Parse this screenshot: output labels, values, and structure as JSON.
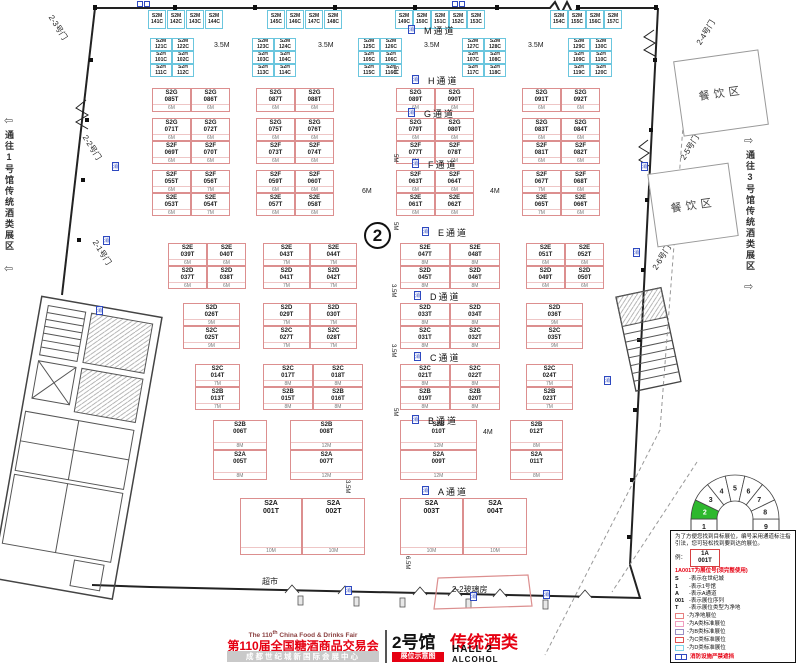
{
  "hall_circle": "2",
  "marker_glyph": "消",
  "corridor_left": {
    "text": "通往1号馆传统酒类展区",
    "arrow": "⇦"
  },
  "corridor_right": {
    "text": "通往3号馆传统酒类展区",
    "arrow": "⇨"
  },
  "doors": [
    {
      "label": "2-3号门",
      "x": 44,
      "y": 22,
      "side": "left"
    },
    {
      "label": "2-2号门",
      "x": 78,
      "y": 142,
      "side": "left"
    },
    {
      "label": "2-1号门",
      "x": 88,
      "y": 247,
      "side": "left"
    },
    {
      "label": "2-4号门",
      "x": 692,
      "y": 27,
      "side": "right"
    },
    {
      "label": "2-5号门",
      "x": 676,
      "y": 142,
      "side": "right"
    },
    {
      "label": "2-6号门",
      "x": 648,
      "y": 252,
      "side": "right"
    }
  ],
  "dining": [
    {
      "label": "餐饮区",
      "x": 678,
      "y": 55,
      "w": 86,
      "h": 76
    },
    {
      "label": "餐饮区",
      "x": 652,
      "y": 168,
      "w": 82,
      "h": 74
    }
  ],
  "aisles": [
    {
      "label": "M通道",
      "x": 424,
      "y": 24
    },
    {
      "label": "H通道",
      "x": 428,
      "y": 74
    },
    {
      "label": "G通道",
      "x": 424,
      "y": 107
    },
    {
      "label": "F通道",
      "x": 428,
      "y": 158
    },
    {
      "label": "E通道",
      "x": 438,
      "y": 226
    },
    {
      "label": "D通道",
      "x": 430,
      "y": 290
    },
    {
      "label": "C通道",
      "x": 430,
      "y": 351
    },
    {
      "label": "B通道",
      "x": 428,
      "y": 414
    },
    {
      "label": "A通道",
      "x": 438,
      "y": 485
    }
  ],
  "dims_h": [
    [
      "6M",
      362,
      188
    ],
    [
      "4M",
      490,
      188
    ],
    [
      "4M",
      483,
      429
    ],
    [
      "3.5M",
      214,
      42
    ],
    [
      "3.5M",
      318,
      42
    ],
    [
      "3.5M",
      424,
      42
    ],
    [
      "3.5M",
      528,
      42
    ]
  ],
  "dims_v": [
    [
      "5M",
      398,
      66
    ],
    [
      "5M",
      398,
      154
    ],
    [
      "5M",
      398,
      222
    ],
    [
      "3.5M",
      396,
      284
    ],
    [
      "3.5M",
      396,
      344
    ],
    [
      "5M",
      398,
      408
    ],
    [
      "3.5M",
      350,
      480
    ],
    [
      "6.5M",
      410,
      556
    ]
  ],
  "markers": [
    [
      112,
      162
    ],
    [
      103,
      236
    ],
    [
      96,
      306
    ],
    [
      641,
      162
    ],
    [
      633,
      248
    ],
    [
      604,
      376
    ],
    [
      345,
      586
    ],
    [
      470,
      592
    ],
    [
      543,
      590
    ]
  ],
  "sensors": [
    [
      137,
      1
    ],
    [
      452,
      1
    ]
  ],
  "misc": {
    "supermarket": "超市",
    "glasshouse": "2-2玻璃房"
  },
  "booths": {
    "standard": [
      [
        152,
        88,
        39,
        24,
        "S2G",
        "085T",
        "6M"
      ],
      [
        191,
        88,
        39,
        24,
        "S2G",
        "086T",
        "6M"
      ],
      [
        256,
        88,
        39,
        24,
        "S2G",
        "087T",
        "6M"
      ],
      [
        295,
        88,
        39,
        24,
        "S2G",
        "088T",
        "6M"
      ],
      [
        396,
        88,
        39,
        24,
        "S2G",
        "089T",
        "6M"
      ],
      [
        435,
        88,
        39,
        24,
        "S2G",
        "090T",
        "6M"
      ],
      [
        522,
        88,
        39,
        24,
        "S2G",
        "091T",
        "6M"
      ],
      [
        561,
        88,
        39,
        24,
        "S2G",
        "092T",
        "6M"
      ],
      [
        152,
        118,
        39,
        23,
        "S2G",
        "071T",
        "6M"
      ],
      [
        191,
        118,
        39,
        23,
        "S2G",
        "072T",
        "6M"
      ],
      [
        256,
        118,
        39,
        23,
        "S2G",
        "075T",
        "6M"
      ],
      [
        295,
        118,
        39,
        23,
        "S2G",
        "076T",
        "6M"
      ],
      [
        396,
        118,
        39,
        23,
        "S2G",
        "079T",
        "6M"
      ],
      [
        435,
        118,
        39,
        23,
        "S2G",
        "080T",
        "6M"
      ],
      [
        522,
        118,
        39,
        23,
        "S2G",
        "083T",
        "6M"
      ],
      [
        561,
        118,
        39,
        23,
        "S2G",
        "084T",
        "6M"
      ],
      [
        152,
        141,
        39,
        23,
        "S2F",
        "069T",
        "6M"
      ],
      [
        191,
        141,
        39,
        23,
        "S2F",
        "070T",
        "6M"
      ],
      [
        256,
        141,
        39,
        23,
        "S2F",
        "073T",
        "6M"
      ],
      [
        295,
        141,
        39,
        23,
        "S2F",
        "074T",
        "6M"
      ],
      [
        396,
        141,
        39,
        23,
        "S2F",
        "077T",
        "6M"
      ],
      [
        435,
        141,
        39,
        23,
        "S2F",
        "078T",
        "6M"
      ],
      [
        522,
        141,
        39,
        23,
        "S2F",
        "081T",
        "6M"
      ],
      [
        561,
        141,
        39,
        23,
        "S2F",
        "082T",
        "6M"
      ],
      [
        152,
        170,
        39,
        23,
        "S2F",
        "055T",
        "6M"
      ],
      [
        191,
        170,
        39,
        23,
        "S2F",
        "056T",
        "7M"
      ],
      [
        256,
        170,
        39,
        23,
        "S2F",
        "059T",
        "6M"
      ],
      [
        295,
        170,
        39,
        23,
        "S2F",
        "060T",
        "6M"
      ],
      [
        396,
        170,
        39,
        23,
        "S2F",
        "063T",
        "6M"
      ],
      [
        435,
        170,
        39,
        23,
        "S2F",
        "064T",
        "6M"
      ],
      [
        522,
        170,
        39,
        23,
        "S2F",
        "067T",
        "7M"
      ],
      [
        561,
        170,
        39,
        23,
        "S2F",
        "068T",
        "6M"
      ],
      [
        152,
        193,
        39,
        23,
        "S2E",
        "053T",
        "6M"
      ],
      [
        191,
        193,
        39,
        23,
        "S2E",
        "054T",
        "7M"
      ],
      [
        256,
        193,
        39,
        23,
        "S2E",
        "057T",
        "6M"
      ],
      [
        295,
        193,
        39,
        23,
        "S2E",
        "058T",
        "6M"
      ],
      [
        396,
        193,
        39,
        23,
        "S2E",
        "061T",
        "6M"
      ],
      [
        435,
        193,
        39,
        23,
        "S2E",
        "062T",
        "6M"
      ],
      [
        522,
        193,
        39,
        23,
        "S2E",
        "065T",
        "7M"
      ],
      [
        561,
        193,
        39,
        23,
        "S2E",
        "066T",
        "6M"
      ],
      [
        168,
        243,
        39,
        23,
        "S2E",
        "039T",
        "6M"
      ],
      [
        207,
        243,
        39,
        23,
        "S2E",
        "040T",
        "6M"
      ],
      [
        263,
        243,
        47,
        23,
        "S2E",
        "043T",
        "7M"
      ],
      [
        310,
        243,
        47,
        23,
        "S2E",
        "044T",
        "7M"
      ],
      [
        400,
        243,
        50,
        23,
        "S2E",
        "047T",
        "8M"
      ],
      [
        450,
        243,
        50,
        23,
        "S2E",
        "048T",
        "8M"
      ],
      [
        526,
        243,
        39,
        23,
        "S2E",
        "051T",
        "6M"
      ],
      [
        565,
        243,
        39,
        23,
        "S2E",
        "052T",
        "6M"
      ],
      [
        168,
        266,
        39,
        23,
        "S2D",
        "037T",
        "6M"
      ],
      [
        207,
        266,
        39,
        23,
        "S2D",
        "038T",
        "6M"
      ],
      [
        263,
        266,
        47,
        23,
        "S2D",
        "041T",
        "7M"
      ],
      [
        310,
        266,
        47,
        23,
        "S2D",
        "042T",
        "7M"
      ],
      [
        400,
        266,
        50,
        23,
        "S2D",
        "045T",
        "8M"
      ],
      [
        450,
        266,
        50,
        23,
        "S2D",
        "046T",
        "8M"
      ],
      [
        526,
        266,
        39,
        23,
        "S2D",
        "049T",
        "6M"
      ],
      [
        565,
        266,
        39,
        23,
        "S2D",
        "050T",
        "6M"
      ],
      [
        183,
        303,
        57,
        23,
        "S2D",
        "026T",
        "9M"
      ],
      [
        263,
        303,
        47,
        23,
        "S2D",
        "029T",
        "7M"
      ],
      [
        310,
        303,
        47,
        23,
        "S2D",
        "030T",
        "7M"
      ],
      [
        400,
        303,
        50,
        23,
        "S2D",
        "033T",
        "8M"
      ],
      [
        450,
        303,
        50,
        23,
        "S2D",
        "034T",
        "8M"
      ],
      [
        526,
        303,
        57,
        23,
        "S2D",
        "036T",
        "9M"
      ],
      [
        183,
        326,
        57,
        23,
        "S2C",
        "025T",
        "9M"
      ],
      [
        263,
        326,
        47,
        23,
        "S2C",
        "027T",
        "7M"
      ],
      [
        310,
        326,
        47,
        23,
        "S2C",
        "028T",
        "7M"
      ],
      [
        400,
        326,
        50,
        23,
        "S2C",
        "031T",
        "8M"
      ],
      [
        450,
        326,
        50,
        23,
        "S2C",
        "032T",
        "8M"
      ],
      [
        526,
        326,
        57,
        23,
        "S2C",
        "035T",
        "9M"
      ],
      [
        195,
        364,
        45,
        23,
        "S2C",
        "014T",
        "7M"
      ],
      [
        263,
        364,
        50,
        23,
        "S2C",
        "017T",
        "8M"
      ],
      [
        313,
        364,
        50,
        23,
        "S2C",
        "018T",
        "8M"
      ],
      [
        400,
        364,
        50,
        23,
        "S2C",
        "021T",
        "8M"
      ],
      [
        450,
        364,
        50,
        23,
        "S2C",
        "022T",
        "8M"
      ],
      [
        526,
        364,
        47,
        23,
        "S2C",
        "024T",
        "7M"
      ],
      [
        195,
        387,
        45,
        23,
        "S2B",
        "013T",
        "7M"
      ],
      [
        263,
        387,
        50,
        23,
        "S2B",
        "015T",
        "8M"
      ],
      [
        313,
        387,
        50,
        23,
        "S2B",
        "016T",
        "8M"
      ],
      [
        400,
        387,
        50,
        23,
        "S2B",
        "019T",
        "8M"
      ],
      [
        450,
        387,
        50,
        23,
        "S2B",
        "020T",
        "8M"
      ],
      [
        526,
        387,
        47,
        23,
        "S2B",
        "023T",
        "7M"
      ],
      [
        213,
        420,
        54,
        30,
        "S2B",
        "006T",
        "8M"
      ],
      [
        290,
        420,
        73,
        30,
        "S2B",
        "008T",
        "12M"
      ],
      [
        400,
        420,
        77,
        30,
        "S2B",
        "010T",
        "12M"
      ],
      [
        510,
        420,
        53,
        30,
        "S2B",
        "012T",
        "8M"
      ],
      [
        213,
        450,
        54,
        30,
        "S2A",
        "005T",
        "8M"
      ],
      [
        290,
        450,
        73,
        30,
        "S2A",
        "007T",
        "12M"
      ],
      [
        400,
        450,
        77,
        30,
        "S2A",
        "009T",
        "12M"
      ],
      [
        510,
        450,
        53,
        30,
        "S2A",
        "011T",
        "8M"
      ],
      [
        240,
        498,
        62,
        57,
        "S2A",
        "001T",
        "10M"
      ],
      [
        302,
        498,
        63,
        57,
        "S2A",
        "002T",
        "10M"
      ],
      [
        400,
        498,
        63,
        57,
        "S2A",
        "003T",
        "10M"
      ],
      [
        463,
        498,
        64,
        57,
        "S2A",
        "004T",
        "10M"
      ]
    ],
    "small": [
      [
        148,
        10,
        18,
        19,
        "S2M",
        "141C"
      ],
      [
        167,
        10,
        18,
        19,
        "S2M",
        "142C"
      ],
      [
        186,
        10,
        18,
        19,
        "S2M",
        "143C"
      ],
      [
        205,
        10,
        18,
        19,
        "S2M",
        "144C"
      ],
      [
        267,
        10,
        18,
        19,
        "S2M",
        "145C"
      ],
      [
        286,
        10,
        18,
        19,
        "S2M",
        "146C"
      ],
      [
        305,
        10,
        18,
        19,
        "S2M",
        "147C"
      ],
      [
        324,
        10,
        18,
        19,
        "S2M",
        "148C"
      ],
      [
        395,
        10,
        18,
        19,
        "S2M",
        "149C"
      ],
      [
        413,
        10,
        18,
        19,
        "S2M",
        "150C"
      ],
      [
        431,
        10,
        18,
        19,
        "S2M",
        "151C"
      ],
      [
        449,
        10,
        18,
        19,
        "S2M",
        "152C"
      ],
      [
        467,
        10,
        18,
        19,
        "S2M",
        "153C"
      ],
      [
        550,
        10,
        18,
        19,
        "S2M",
        "154C"
      ],
      [
        568,
        10,
        18,
        19,
        "S2M",
        "155C"
      ],
      [
        586,
        10,
        18,
        19,
        "S2M",
        "156C"
      ],
      [
        604,
        10,
        18,
        19,
        "S2M",
        "157C"
      ],
      [
        150,
        38,
        22,
        13,
        "S2M",
        "121C"
      ],
      [
        172,
        38,
        22,
        13,
        "S2M",
        "122C"
      ],
      [
        252,
        38,
        22,
        13,
        "S2M",
        "123C"
      ],
      [
        274,
        38,
        22,
        13,
        "S2M",
        "124C"
      ],
      [
        358,
        38,
        22,
        13,
        "S2M",
        "125C"
      ],
      [
        380,
        38,
        22,
        13,
        "S2M",
        "126C"
      ],
      [
        462,
        38,
        22,
        13,
        "S2M",
        "127C"
      ],
      [
        484,
        38,
        22,
        13,
        "S2M",
        "128C"
      ],
      [
        568,
        38,
        22,
        13,
        "S2M",
        "129C"
      ],
      [
        590,
        38,
        22,
        13,
        "S2M",
        "130C"
      ],
      [
        150,
        51,
        22,
        13,
        "S2H",
        "101C"
      ],
      [
        172,
        51,
        22,
        13,
        "S2H",
        "102C"
      ],
      [
        252,
        51,
        22,
        13,
        "S2H",
        "103C"
      ],
      [
        274,
        51,
        22,
        13,
        "S2H",
        "104C"
      ],
      [
        358,
        51,
        22,
        13,
        "S2H",
        "105C"
      ],
      [
        380,
        51,
        22,
        13,
        "S2H",
        "106C"
      ],
      [
        462,
        51,
        22,
        13,
        "S2H",
        "107C"
      ],
      [
        484,
        51,
        22,
        13,
        "S2H",
        "108C"
      ],
      [
        568,
        51,
        22,
        13,
        "S2H",
        "109C"
      ],
      [
        590,
        51,
        22,
        13,
        "S2H",
        "110C"
      ],
      [
        150,
        64,
        22,
        13,
        "S2H",
        "111C"
      ],
      [
        172,
        64,
        22,
        13,
        "S2H",
        "112C"
      ],
      [
        252,
        64,
        22,
        13,
        "S2H",
        "113C"
      ],
      [
        274,
        64,
        22,
        13,
        "S2H",
        "114C"
      ],
      [
        358,
        64,
        22,
        13,
        "S2H",
        "115C"
      ],
      [
        380,
        64,
        22,
        13,
        "S2H",
        "116C"
      ],
      [
        462,
        64,
        22,
        13,
        "S2H",
        "117C"
      ],
      [
        484,
        64,
        22,
        13,
        "S2H",
        "118C"
      ],
      [
        568,
        64,
        22,
        13,
        "S2H",
        "119C"
      ],
      [
        590,
        64,
        22,
        13,
        "S2H",
        "120C"
      ]
    ]
  },
  "legend": {
    "intro": "为了方便您找到目标展位，编号采用通道标注指引法，您可轻松找到要到达的展位。",
    "example_label": "例：",
    "sample_line1": "1A",
    "sample_line2": "001T",
    "title": "1A001T为展位号(须完整使用)",
    "items": [
      {
        "key": "S",
        "desc": "-表示在世纪城"
      },
      {
        "key": "1",
        "desc": "-表示1号馆"
      },
      {
        "key": "A",
        "desc": "-表示A通道"
      },
      {
        "key": "001",
        "desc": "-表示展位序列"
      },
      {
        "key": "T",
        "desc": "-表示展位类型为净地"
      }
    ],
    "swatches": [
      {
        "color": "#e88080",
        "label": "-为净地展位"
      },
      {
        "color": "#f09ec0",
        "label": "-为A类标准展位"
      },
      {
        "color": "#9b8ec4",
        "label": "-为B类标准展位"
      },
      {
        "color": "#e05252",
        "label": "-为C类标准展位"
      },
      {
        "color": "#7fd4e8",
        "label": "-为D类标准展位"
      }
    ],
    "fire_note": "消防设施严禁遮挡"
  },
  "fan": {
    "halls": [
      "1",
      "2",
      "3",
      "4",
      "5",
      "6",
      "7",
      "8",
      "9"
    ],
    "active": "2",
    "active_color": "#2eb82e"
  },
  "footer": {
    "en_prefix": "The 110",
    "en_sup": "th",
    "en_suffix": " China Food & Drinks Fair",
    "cn_title": "第110届全国糖酒商品交易会",
    "venue": "成都世纪城新国际会展中心",
    "hall_cn": "2号馆",
    "hall_type": "传统酒类",
    "badge": "展位示意图",
    "hall_en": "HALL 2",
    "hall_type_en": "ALCOHOL"
  }
}
